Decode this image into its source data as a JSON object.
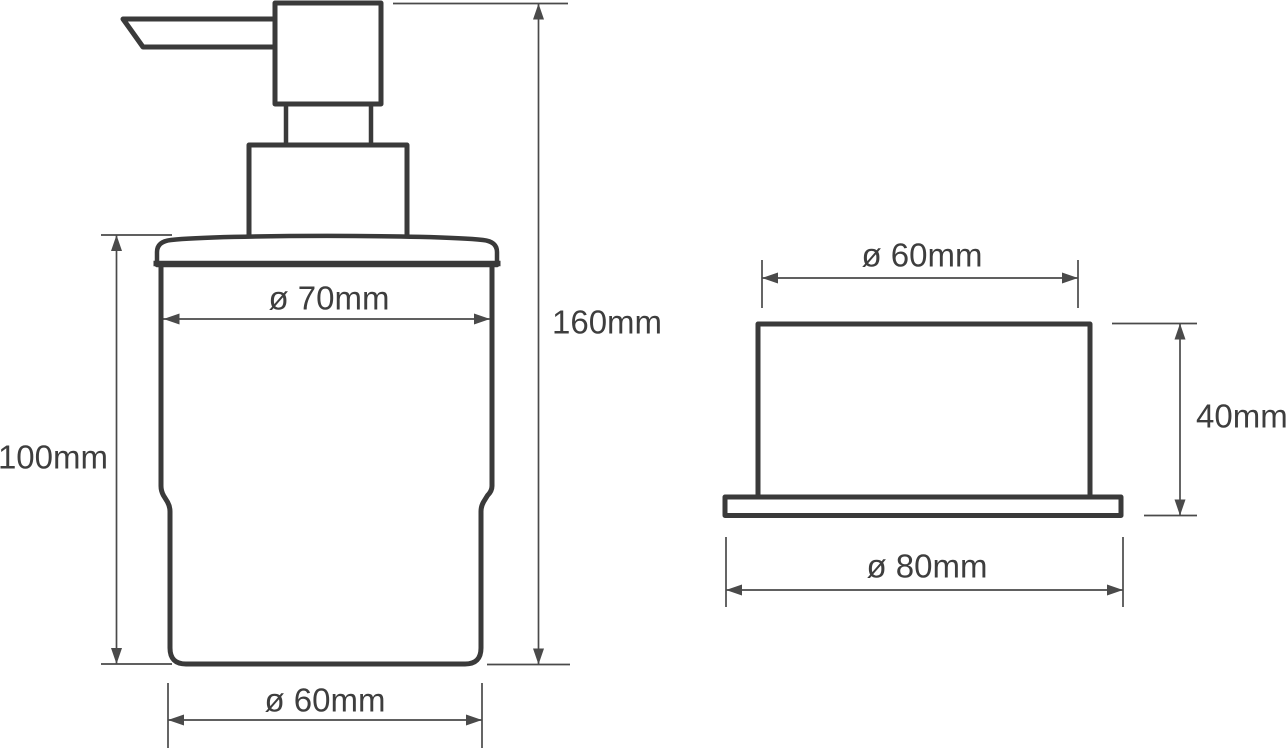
{
  "drawing": {
    "type": "technical-dimension-diagram",
    "subject": "soap dispenser with wall holder",
    "background": "#ffffff",
    "line_color": "#3a3a3a",
    "dim_color": "#4a4a4a",
    "text_color": "#3e3e3e",
    "views": {
      "dispenser": {
        "name": "dispenser side view with pump",
        "labels": {
          "body_diameter": "ø 70mm",
          "body_height": "100mm",
          "total_height": "160mm",
          "base_diameter": "ø 60mm"
        }
      },
      "holder": {
        "name": "holder front view",
        "labels": {
          "cup_diameter": "ø 60mm",
          "height": "40mm",
          "flange_diameter": "ø 80mm"
        }
      }
    }
  }
}
